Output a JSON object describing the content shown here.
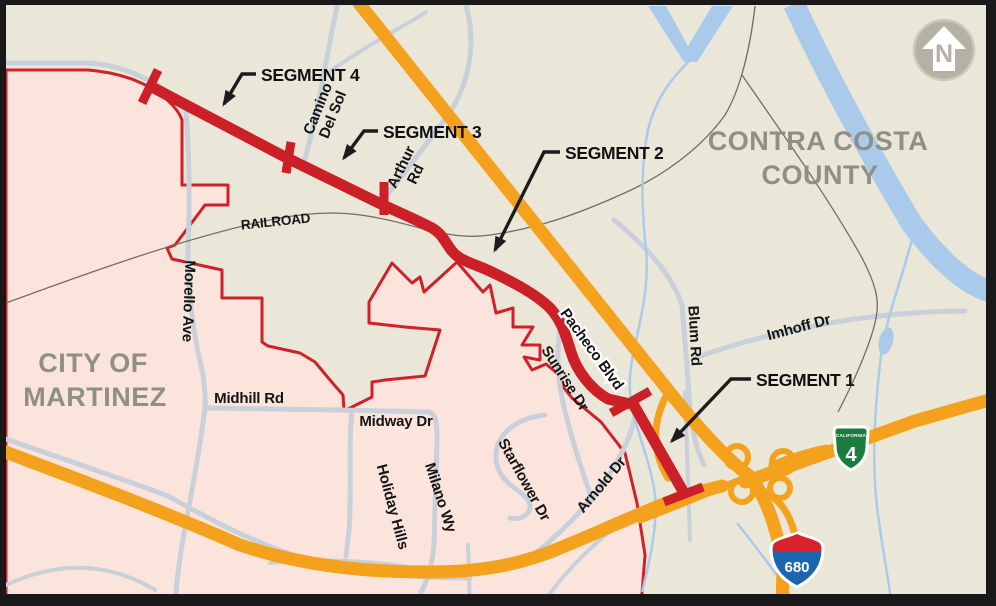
{
  "regions": {
    "county": {
      "line1": "CONTRA COSTA",
      "line2": "COUNTY"
    },
    "city": {
      "line1": "CITY OF",
      "line2": "MARTINEZ"
    }
  },
  "segments": {
    "s4": "SEGMENT 4",
    "s3": "SEGMENT 3",
    "s2": "SEGMENT 2",
    "s1": "SEGMENT 1"
  },
  "roads": {
    "railroad": "RAILROAD",
    "camino1": "Camino",
    "camino2": "Del Sol",
    "arthur1": "Arthur",
    "arthur2": "Rd",
    "morello": "Morello Ave",
    "midhill": "Midhill Rd",
    "midway": "Midway Dr",
    "holiday": "Holiday Hills",
    "milano": "Milano Wy",
    "starflower": "Starflower Dr",
    "sunrise": "Sunrise Dr",
    "arnold": "Arnold Dr",
    "pacheco": "Pacheco Blvd",
    "blum": "Blum Rd",
    "imhoff": "Imhoff Dr"
  },
  "shields": {
    "ca4_state": "CALIFORNIA",
    "ca4_num": "4",
    "i680_num": "680"
  },
  "north_arrow": {
    "letter": "N"
  },
  "colors": {
    "background": "#eae7d9",
    "city_fill": "#fbe4dc",
    "boundary_red": "#d02128",
    "project_red": "#cb2027",
    "highway_orange": "#f4a21e",
    "road_gray": "#c9d0d9",
    "water_blue": "#aacaec",
    "railroad_gray": "#6e6e64",
    "label_black": "#1a1a1a",
    "region_gray": "#8f8f85",
    "shield_green": "#1a7c3e",
    "shield_blue": "#1b66ae",
    "shield_red": "#d8232b",
    "frame": "#191919"
  }
}
